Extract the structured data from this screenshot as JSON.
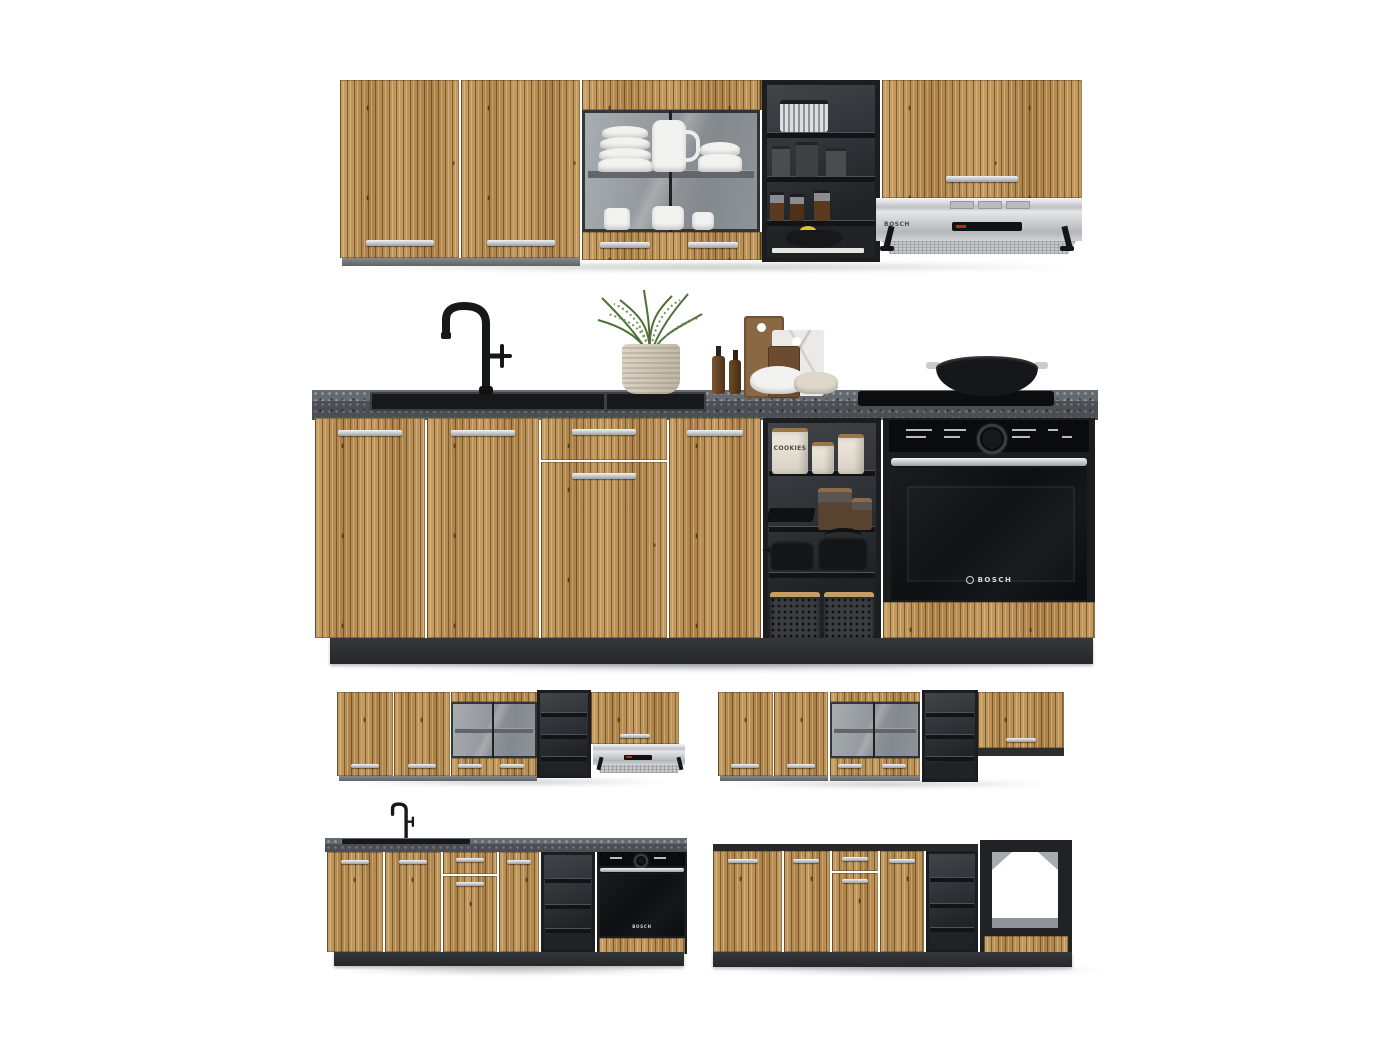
{
  "scene": {
    "type": "product-photo",
    "subject": "Modular kitchen set with fluted oak fronts, black carcasses and stone worktop",
    "background_color": "#ffffff"
  },
  "brand": {
    "oven_logo": "BOSCH",
    "hood_logo": "BOSCH"
  },
  "props": {
    "canister_label": "COOKIES"
  },
  "colors": {
    "wood_front": "#bf975c",
    "wood_stripe_dark": "#7d5a33",
    "carcass_dark": "#26292c",
    "open_shelf_black": "#202326",
    "countertop_stone": "#4b4e53",
    "plinth": "#2c2e32",
    "stainless_steel": "#c9cccf",
    "handle_silver": "#d9dbde",
    "oven_black": "#0e0f11",
    "accent_red": "#c0241c",
    "plant_green": "#4e6f38",
    "lemon_yellow": "#e3c32a",
    "dishware_white": "#f2f2f0"
  },
  "objects": [
    "wall-cabinets",
    "glass-display-cabinet",
    "open-shelf-unit",
    "range-hood",
    "countertop",
    "sink",
    "faucet",
    "potted-herb",
    "cutting-boards",
    "oil-bottles",
    "serving-bowls",
    "induction-hob",
    "wok-pan",
    "built-in-oven",
    "cookie-canisters",
    "storage-jars",
    "teapots",
    "storage-baskets",
    "oven-housing-module"
  ]
}
